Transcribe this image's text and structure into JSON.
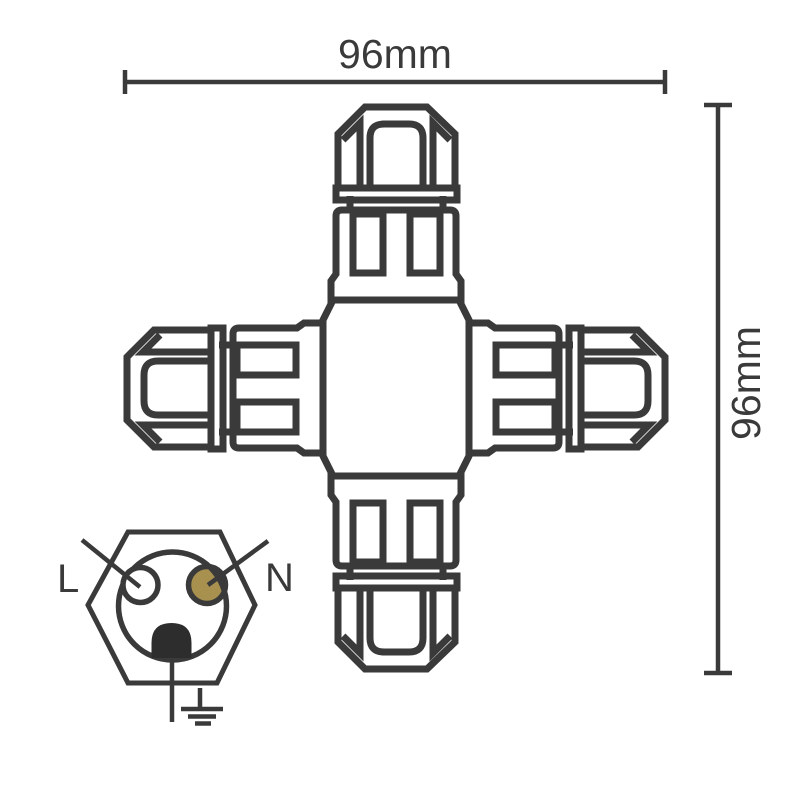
{
  "canvas": {
    "background": "#ffffff",
    "ink": "#3a3a3a"
  },
  "dimensions": {
    "width_label": "96mm",
    "height_label": "96mm"
  },
  "pinout": {
    "live_label": "L",
    "neutral_label": "N",
    "neutral_fill": "#a8914f",
    "ground_fill": "#2d2d2d"
  }
}
